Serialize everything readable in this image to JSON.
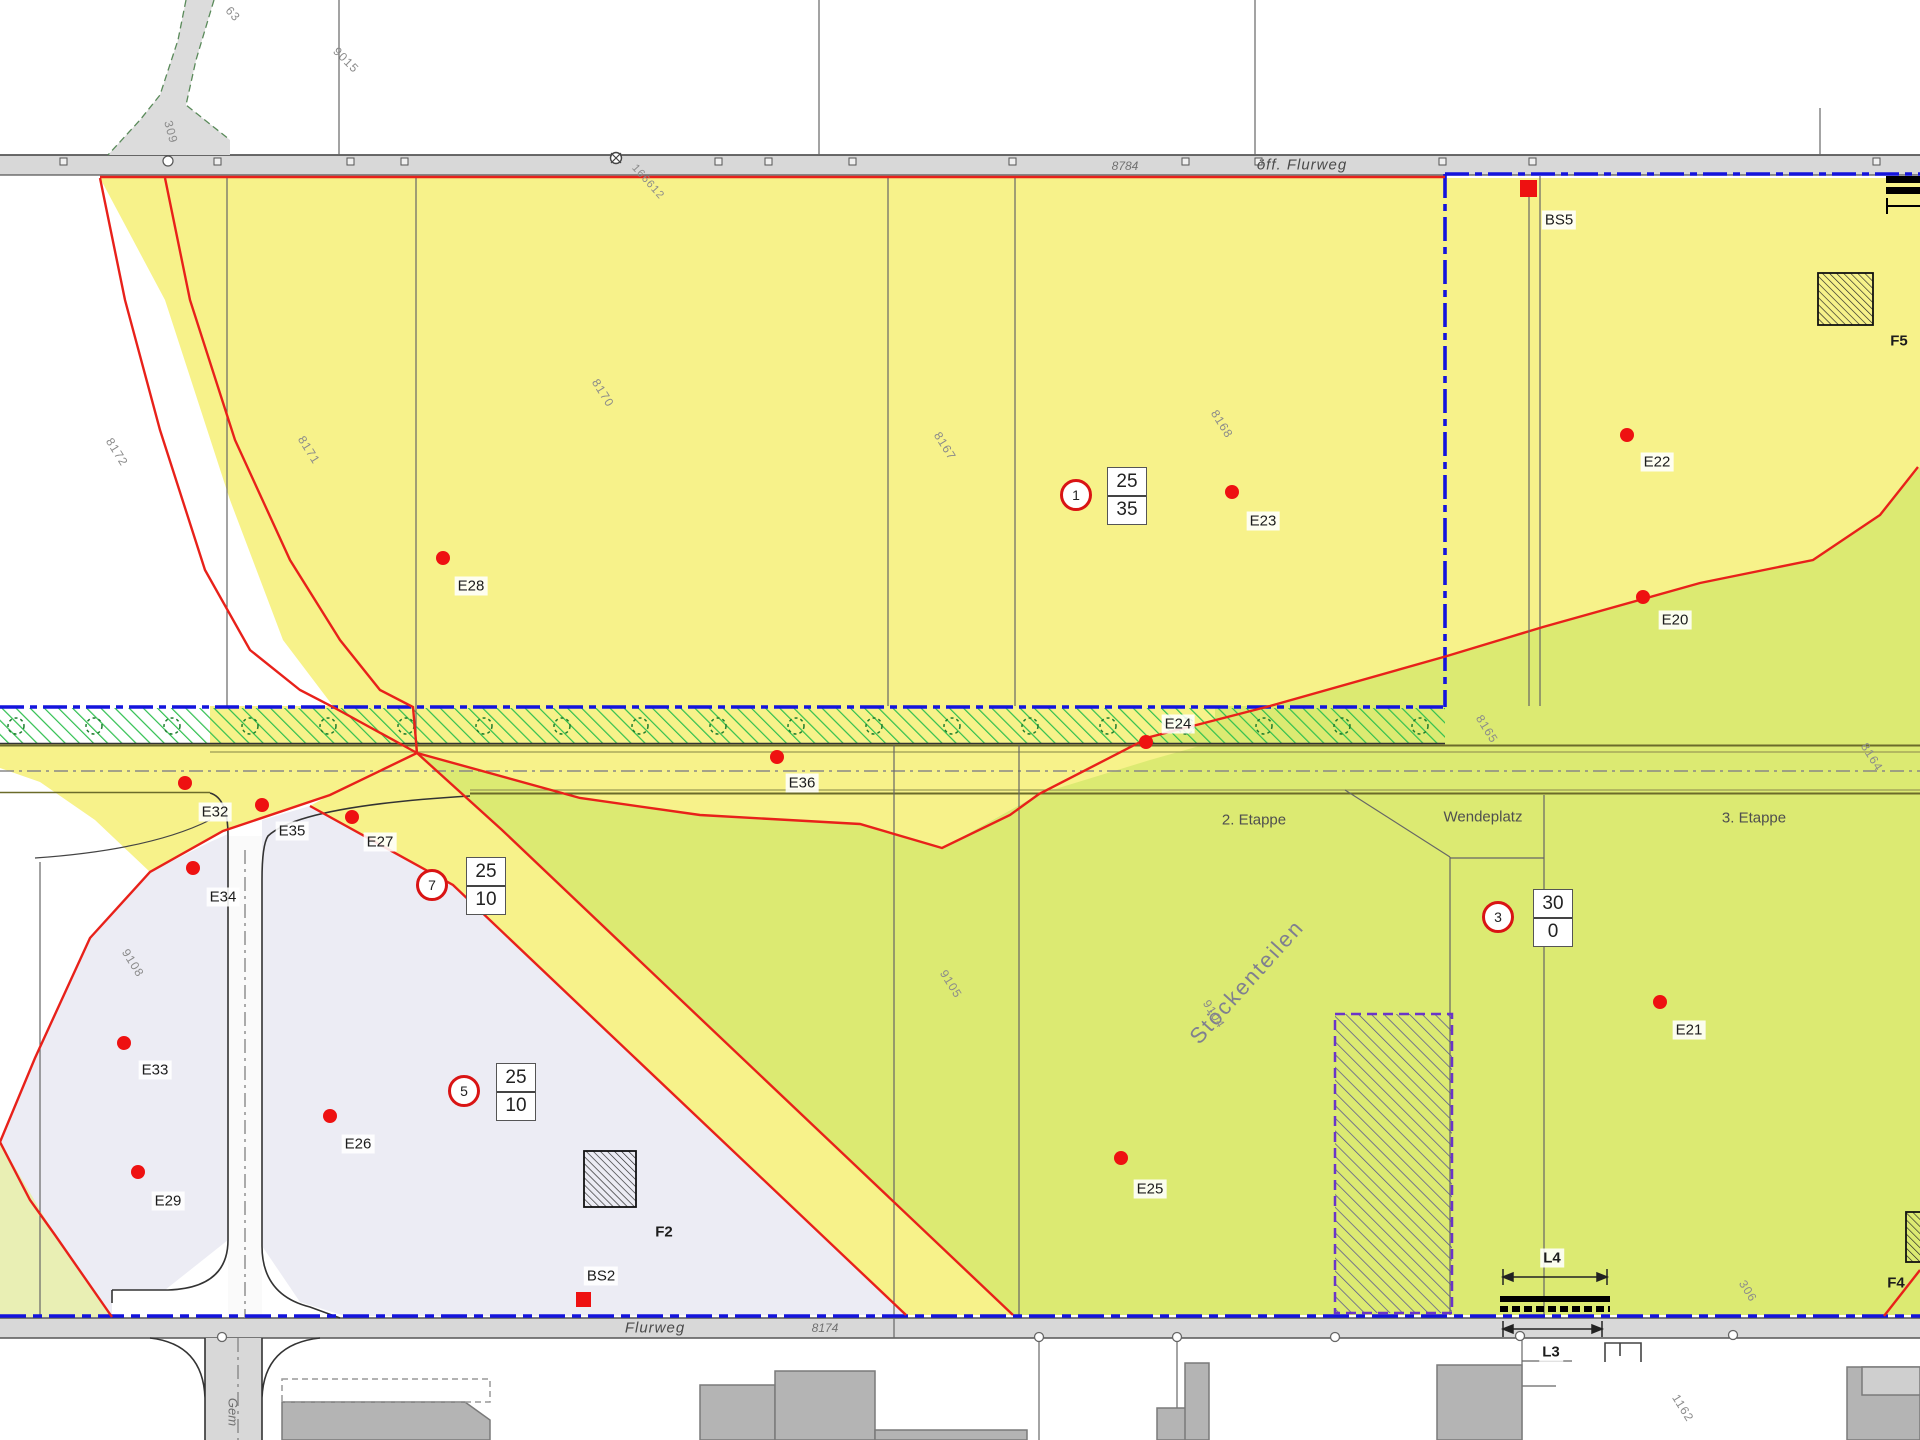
{
  "roads": {
    "top_name": "öff. Flurweg",
    "top_parcel": "8784",
    "bottom_name": "Flurweg",
    "bottom_parcel": "8174",
    "side_name": "Gem",
    "survey_point": "166612"
  },
  "stages": {
    "stage2": "2. Etappe",
    "stage3": "3. Etappe",
    "turning_area": "Wendeplatz",
    "area_name": "Stöckenteilen"
  },
  "signs": [
    {
      "c": "1",
      "t": "25",
      "b": "35"
    },
    {
      "c": "7",
      "t": "25",
      "b": "10"
    },
    {
      "c": "5",
      "t": "25",
      "b": "10"
    },
    {
      "c": "3",
      "t": "30",
      "b": "0"
    }
  ],
  "points": {
    "e20": "E20",
    "e21": "E21",
    "e22": "E22",
    "e23": "E23",
    "e24": "E24",
    "e25": "E25",
    "e26": "E26",
    "e27": "E27",
    "e28": "E28",
    "e29": "E29",
    "e32": "E32",
    "e33": "E33",
    "e34": "E34",
    "e35": "E35",
    "e36": "E36"
  },
  "markers": {
    "bs2": "BS2",
    "bs5": "BS5",
    "f2": "F2",
    "f4": "F4",
    "f5": "F5",
    "l3": "L3",
    "l4": "L4"
  },
  "parcels": {
    "p9015": "9015",
    "p8172": "8172",
    "p8171": "8171",
    "p8170": "8170",
    "p8167": "8167",
    "p8168": "8168",
    "p8165": "8165",
    "p8164": "8164",
    "p9108": "9108",
    "p9105": "9105",
    "p9104": "9104",
    "p1162": "1162",
    "p306": "306",
    "p63": "63",
    "p309": "309"
  },
  "colors": {
    "zone_yellow": "#f7f28a",
    "zone_green": "#dcea72",
    "zone_lavender": "#ececf4",
    "zone_palegreen": "#e9efb4",
    "road_gray": "#d8d8d8",
    "boundary_red": "#e8211a",
    "perimeter_blue": "#1414dd",
    "reserve_purple": "#6a35c8",
    "planting_green": "#2fbf4f"
  }
}
